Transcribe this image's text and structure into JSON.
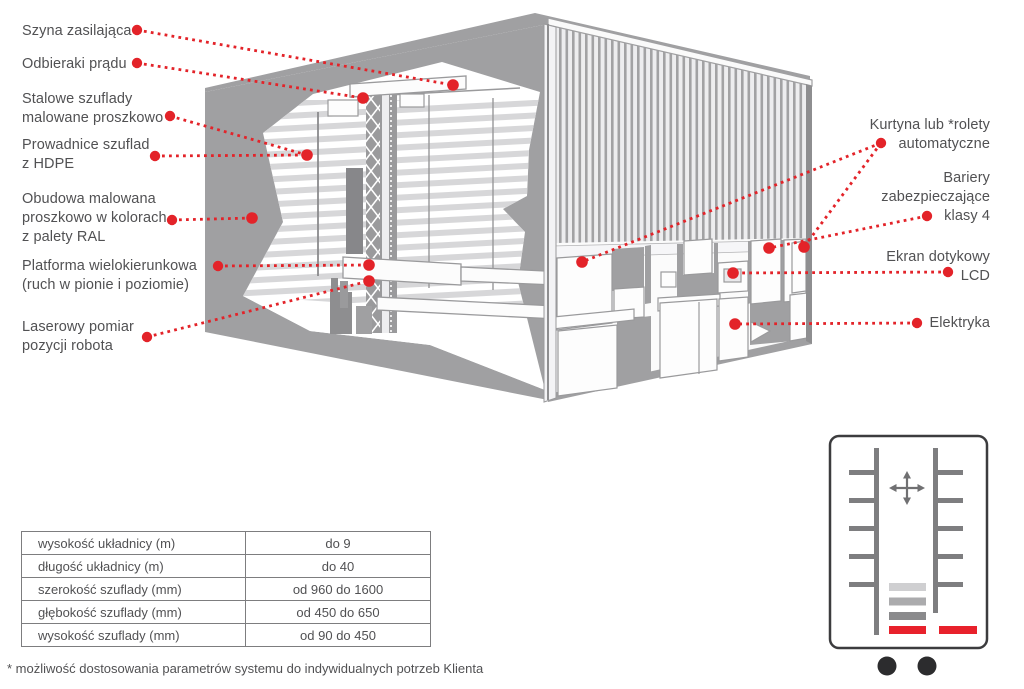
{
  "colors": {
    "accent_red": "#e32329",
    "machine_gray": "#a0a0a2",
    "machine_dark_gray": "#8e8e90",
    "shelf_stripe": "#d7d7d9",
    "text_gray": "#515153",
    "icon_outline": "#3c3c3e"
  },
  "diagram": {
    "left_labels": [
      {
        "text": "Szyna zasilająca"
      },
      {
        "text": "Odbieraki prądu"
      },
      {
        "text": "Stalowe szuflady\nmalowane proszkowo"
      },
      {
        "text": "Prowadnice szuflad\nz HDPE"
      },
      {
        "text": "Obudowa malowana\nproszkowo w kolorach\nz palety RAL"
      },
      {
        "text": "Platforma wielokierunkowa\n(ruch w pionie i poziomie)"
      },
      {
        "text": "Laserowy pomiar\npozycji robota"
      }
    ],
    "right_labels": [
      {
        "text": "Kurtyna lub *rolety\nautomatyczne"
      },
      {
        "text": "Bariery\nzabezpieczające\nklasy 4"
      },
      {
        "text": "Ekran dotykowy\nLCD"
      },
      {
        "text": "Elektryka"
      }
    ]
  },
  "spec_table": {
    "rows": [
      {
        "param": "wysokość układnicy (m)",
        "value": "do 9"
      },
      {
        "param": "długość układnicy (m)",
        "value": "do 40"
      },
      {
        "param": "szerokość szuflady (mm)",
        "value": "od 960 do 1600"
      },
      {
        "param": "głębokość szuflady (mm)",
        "value": "od 450 do 650"
      },
      {
        "param": "wysokość szuflady (mm)",
        "value": "od 90 do 450"
      }
    ]
  },
  "footnote": "* możliwość dostosowania parametrów systemu do indywidualnych potrzeb Klienta"
}
